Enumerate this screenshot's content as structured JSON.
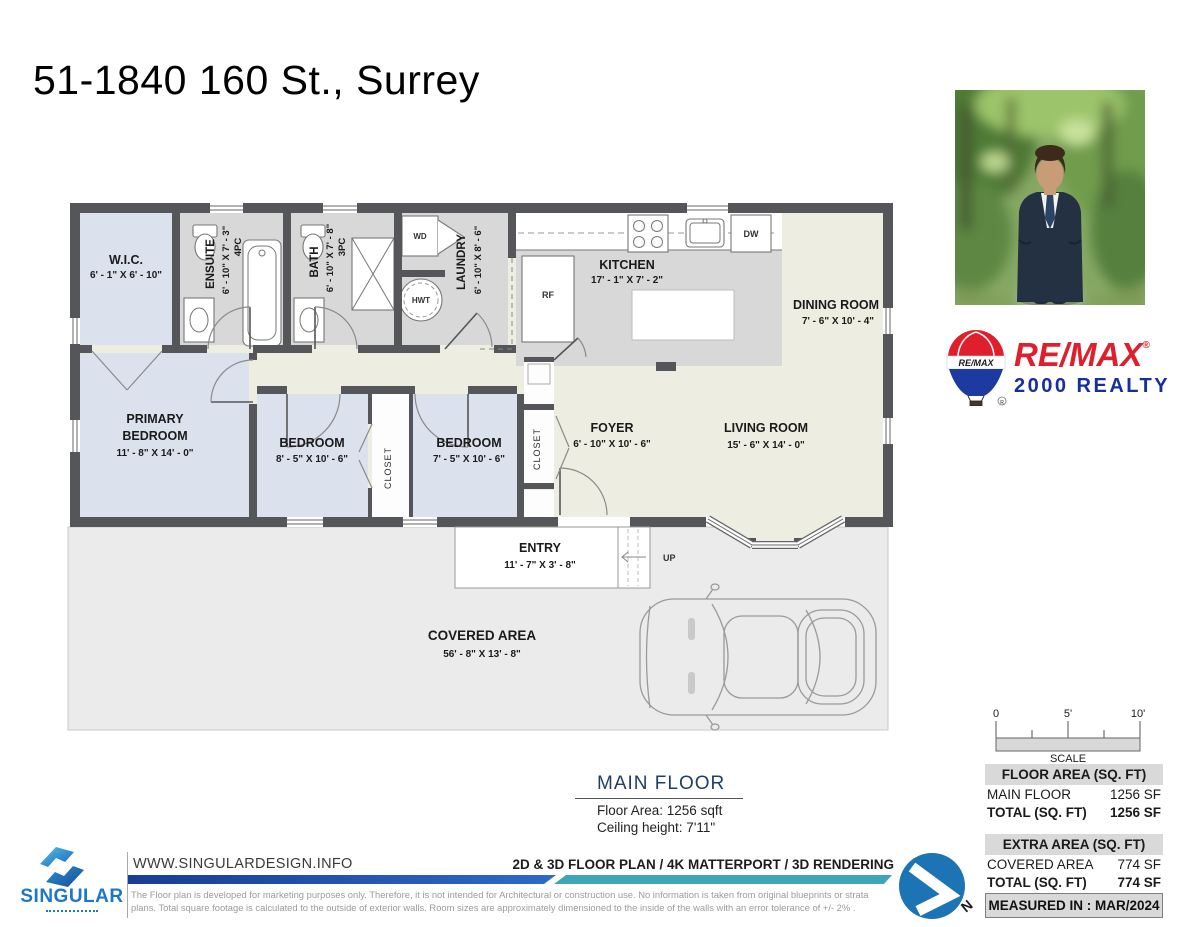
{
  "page": {
    "title": "51-1840 160 St., Surrey"
  },
  "plan": {
    "wic": {
      "name": "W.I.C.",
      "dims": "6' - 1\" X 6' - 10\""
    },
    "ensuite": {
      "name": "ENSUITE",
      "dims": "6' - 10\" X 7' - 3\"",
      "pc": "4PC"
    },
    "bath": {
      "name": "BATH",
      "dims": "6' - 10\" X 7' - 8\"",
      "pc": "3PC"
    },
    "laundry": {
      "name": "LAUNDRY",
      "dims": "6' - 10\" X 8' - 6\""
    },
    "kitchen": {
      "name": "KITCHEN",
      "dims": "17' - 1\" X 7' - 2\""
    },
    "dining": {
      "name": "DINING ROOM",
      "dims": "7' - 6\" X 10' - 4\""
    },
    "primary": {
      "line1": "PRIMARY",
      "line2": "BEDROOM",
      "dims": "11' - 8\" X 14' - 0\""
    },
    "bedroom2": {
      "name": "BEDROOM",
      "dims": "8' - 5\" X 10' - 6\""
    },
    "bedroom3": {
      "name": "BEDROOM",
      "dims": "7' - 5\" X 10' - 6\""
    },
    "foyer": {
      "name": "FOYER",
      "dims": "6' - 10\" X 10' - 6\""
    },
    "living": {
      "name": "LIVING ROOM",
      "dims": "15' - 6\" X 14' - 0\""
    },
    "entry": {
      "name": "ENTRY",
      "dims": "11' - 7\" X 3' - 8\""
    },
    "covered": {
      "name": "COVERED AREA",
      "dims": "56' - 8\" X 13' - 8\""
    },
    "closet": "CLOSET",
    "up": "UP",
    "appliances": {
      "wd": "WD",
      "hwt": "HWT",
      "rf": "RF",
      "dw": "DW"
    }
  },
  "remax": {
    "balloon": "RE/MAX",
    "wordmark": "RE/MAX",
    "registered": "®",
    "line2": "2000 REALTY"
  },
  "scalebar": {
    "t0": "0",
    "t5": "5'",
    "t10": "10'",
    "label": "SCALE"
  },
  "main_floor": {
    "title": "MAIN FLOOR",
    "area": "Floor Area: 1256 sqft",
    "ceiling": "Ceiling height: 7'11\""
  },
  "tables": {
    "floor": {
      "header": "FLOOR AREA (SQ. FT)",
      "rows": [
        {
          "label": "MAIN FLOOR",
          "value": "1256 SF"
        },
        {
          "label": "TOTAL (SQ. FT)",
          "value": "1256 SF"
        }
      ]
    },
    "extra": {
      "header": "EXTRA AREA (SQ. FT)",
      "rows": [
        {
          "label": "COVERED AREA",
          "value": "774 SF"
        },
        {
          "label": "TOTAL (SQ. FT)",
          "value": "774 SF"
        }
      ]
    },
    "measured": "MEASURED IN : MAR/2024"
  },
  "footer": {
    "brand": "SINGULAR",
    "website": "WWW.SINGULARDESIGN.INFO",
    "services": "2D & 3D FLOOR PLAN / 4K MATTERPORT / 3D RENDERING",
    "disclaimer1": "The Floor plan is developed for marketing purposes only. Therefore, it is not intended for Architectural or construction use. No information is taken from original blueprints or strata",
    "disclaimer2": "plans. Total square footage is calculated to the outside of exterior walls. Room sizes are approximately dimensioned to the inside of the walls with an error tolerance of +/- 2% .",
    "north": "N"
  },
  "colors": {
    "wall_gray": "#55565a",
    "room_blue": "#dbe2ee",
    "room_gray": "#d8d8d8",
    "room_cream": "#edeee1",
    "covered_gray": "#ebebeb",
    "remax_red": "#e01f2d",
    "remax_blue": "#15309c",
    "singular_blue": "#1b78c8",
    "bar_blue": "#1d4f9e",
    "bar_teal": "#3fa6ba",
    "north_blue": "#1d74b5",
    "title_navy": "#1e3f66"
  }
}
